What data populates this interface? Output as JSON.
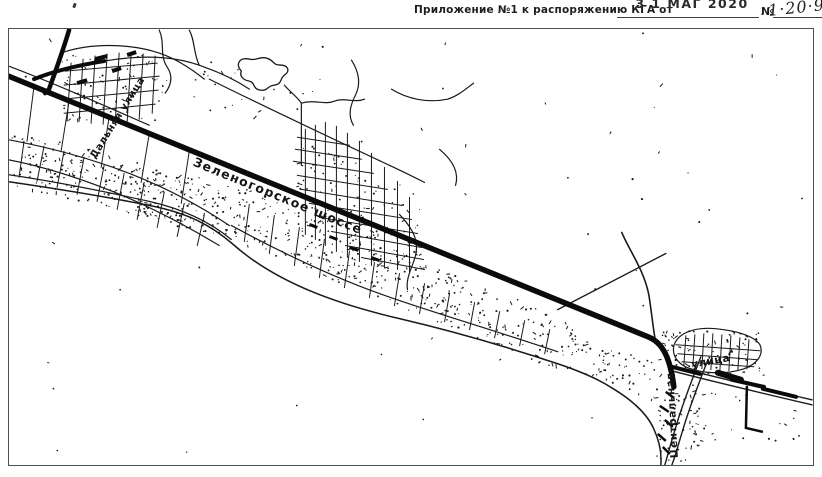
{
  "document": {
    "appendix_label": "Приложение №1 к распоряжению КГА от",
    "date_stamp": "3 1 МАГ 2020",
    "number_sign": "№",
    "number_handwritten": "1·20·9"
  },
  "map": {
    "street_labels": {
      "highway": "Зеленогорское шоссе",
      "left_street": "Дальняя улица",
      "central_street_vertical": "Центральная",
      "central_street_suffix": "улица"
    },
    "colors": {
      "ink": "#1a1a1a",
      "paper": "#ffffff"
    }
  }
}
